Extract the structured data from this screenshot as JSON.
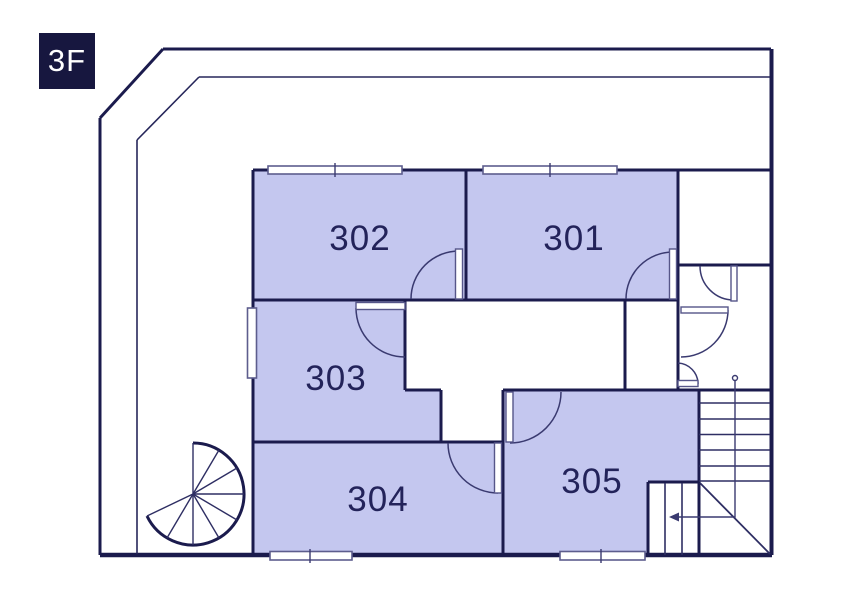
{
  "floor": {
    "label": "3F"
  },
  "rooms": [
    {
      "number": "301"
    },
    {
      "number": "302"
    },
    {
      "number": "303"
    },
    {
      "number": "304"
    },
    {
      "number": "305"
    }
  ],
  "features": {
    "spiral_staircase": "spiral-staircase",
    "main_staircase": "staircase-with-direction-arrow",
    "door_count": 8,
    "window_count": 5
  },
  "colors": {
    "wall": "#1b1b4d",
    "room_fill": "#c4c7ef",
    "floor_badge_bg": "#17173f",
    "label_text": "#23235a",
    "background": "#ffffff"
  }
}
